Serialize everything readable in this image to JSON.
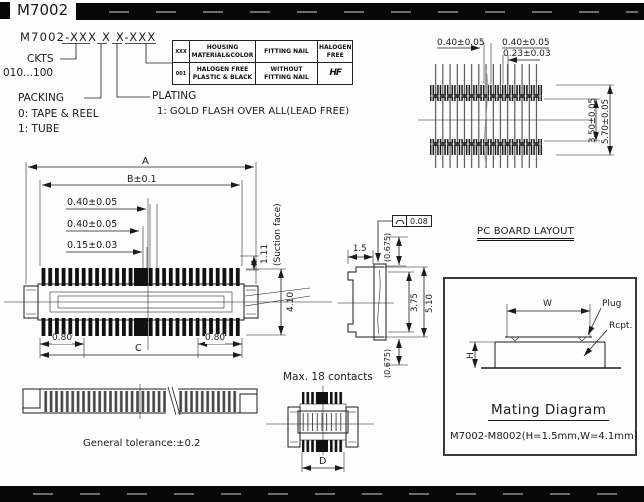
{
  "header": {
    "part_number": "M7002"
  },
  "ordering": {
    "part_code": "M7002-XXX X X-XXX",
    "ckts_label": "CKTS",
    "ckts_range": "010...100",
    "packing_label": "PACKING",
    "packing_option_0": "0: TAPE & REEL",
    "packing_option_1": "1: TUBE",
    "plating_label": "PLATING",
    "plating_option": "1: GOLD FLASH OVER ALL(LEAD FREE)"
  },
  "options_table": {
    "col_code": "XXX",
    "col_housing": "HOUSING MATERIAL&COLOR",
    "col_fitting": "FITTING NAIL",
    "col_halogen": "HALOGEN FREE",
    "row_code": "001",
    "row_housing": "HALOGEN FREE PLASTIC & BLACK",
    "row_fitting": "WITHOUT FITTING NAIL",
    "row_halogen_logo": "HF"
  },
  "pcb_layout": {
    "title": "PC BOARD LAYOUT",
    "dim_pitch": "0.40±0.05",
    "dim_pad_pitch": "0.40±0.05",
    "dim_pad_width": "0.23±0.03",
    "dim_span_inner": "3.50±0.05",
    "dim_span_outer": "5.70±0.05"
  },
  "top_view": {
    "dim_overall": "A",
    "dim_b": "B±0.1",
    "dim_pin_pitch": "0.40±0.05",
    "dim_pin_gap": "0.40±0.05",
    "dim_pin_width": "0.15±0.03",
    "dim_suction_height": "1.11",
    "suction_label": "(Suction face)",
    "dim_depth": "4.10",
    "dim_end_left": "0.80",
    "dim_end_right": "0.80",
    "dim_c": "C"
  },
  "side_view": {
    "dim_width": "1.5",
    "flatness_value": "0.08",
    "dim_top_gap": "(0.675)",
    "dim_inner_height": "3.75",
    "dim_outer_height": "5.10",
    "dim_bottom_gap": "(0.675)"
  },
  "bottom_view": {
    "note": "Max. 18 contacts",
    "dim_d": "D"
  },
  "front_view": {
    "tolerance_note": "General tolerance:±0.2"
  },
  "mating_diagram": {
    "title": "Mating Diagram",
    "spec": "M7002-M8002(H=1.5mm,W=4.1mm)",
    "dim_w": "W",
    "dim_h": "H",
    "plug_label": "Plug",
    "rcpt_label": "Rcpt."
  }
}
